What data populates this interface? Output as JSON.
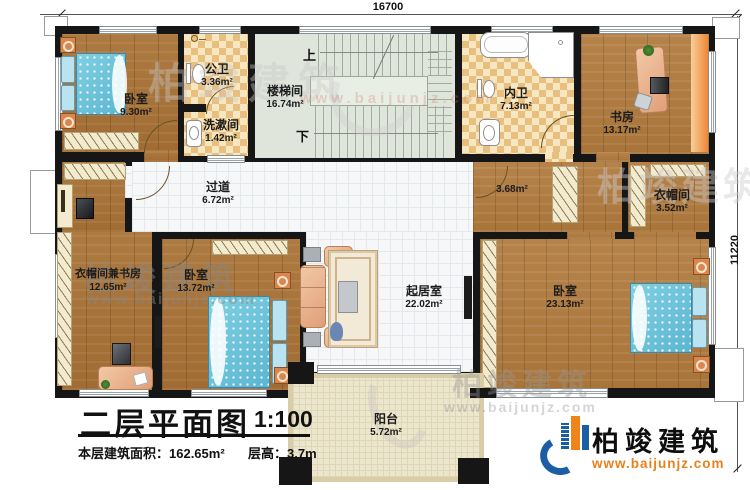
{
  "dimensions": {
    "width_label": "16700",
    "height_label": "11220"
  },
  "stairs": {
    "up": "上",
    "down": "下"
  },
  "rooms": [
    {
      "id": "bedroom-nw",
      "name": "卧室",
      "area": "9.30m²"
    },
    {
      "id": "public-bath",
      "name": "公卫",
      "area": "3.36m²"
    },
    {
      "id": "washroom",
      "name": "洗漱间",
      "area": "1.42m²"
    },
    {
      "id": "stairwell",
      "name": "楼梯间",
      "area": "16.74m²"
    },
    {
      "id": "private-bath",
      "name": "内卫",
      "area": "7.13m²"
    },
    {
      "id": "study",
      "name": "书房",
      "area": "13.17m²"
    },
    {
      "id": "hallway",
      "name": "过道",
      "area": "6.72m²"
    },
    {
      "id": "cloak-study",
      "name": "衣帽间兼书房",
      "area": "12.65m²"
    },
    {
      "id": "bedroom-sw",
      "name": "卧室",
      "area": "13.72m²"
    },
    {
      "id": "living-room",
      "name": "起居室",
      "area": "22.02m²"
    },
    {
      "id": "small-hall",
      "name": "",
      "area": "3.68m²"
    },
    {
      "id": "cloakroom",
      "name": "衣帽间",
      "area": "3.52m²"
    },
    {
      "id": "bedroom-se",
      "name": "卧室",
      "area": "23.13m²"
    },
    {
      "id": "balcony",
      "name": "阳台",
      "area": "5.72m²"
    }
  ],
  "title_block": {
    "title": "二层平面图",
    "scale": "1:100",
    "area_text": "本层建筑面积：162.65m²",
    "height_text": "层高：3.7m"
  },
  "brand": {
    "name": "柏竣建筑",
    "website": "www.baijunjz.com"
  },
  "watermark": {
    "name": "柏竣建筑",
    "website": "www.baijunjz.com"
  },
  "colors": {
    "wall": "#161616",
    "wood": "#ab7a40",
    "checker_tile": "#e8bf7e",
    "white_tile": "#f5f7f8",
    "stair": "#dfe5da",
    "balcony": "#ece6ce",
    "bed_blue": "#6fc6db",
    "brand_blue": "#1b5ea6",
    "brand_orange": "#ef8519"
  }
}
